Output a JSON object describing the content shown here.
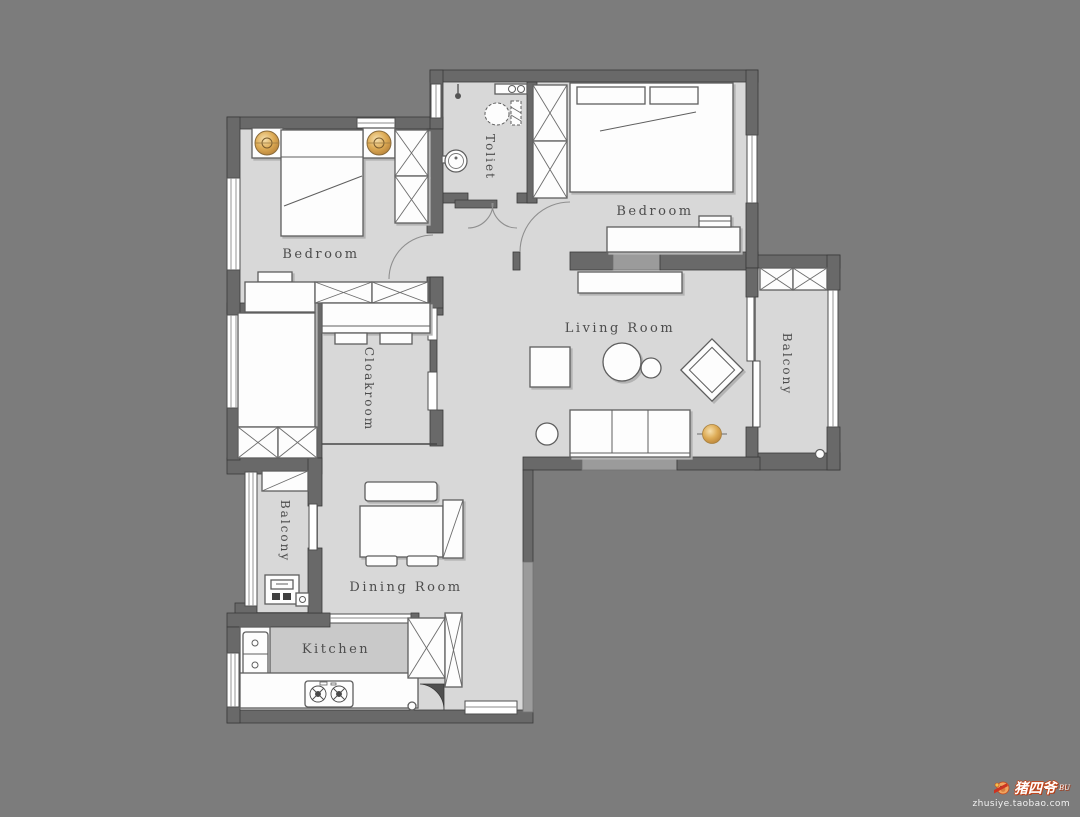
{
  "palette": {
    "background": "#7c7c7c",
    "wall": "#696969",
    "wall_light": "#9b9b9b",
    "floor": "#d8d8d8",
    "furniture": "#fdfdfd",
    "accent_gold": "#d9a84e",
    "label_text": "#4c4c4c"
  },
  "rooms": [
    {
      "id": "bedroom-1",
      "label": "Bedroom",
      "orientation": "horizontal"
    },
    {
      "id": "toilet",
      "label": "Toliet",
      "orientation": "vertical"
    },
    {
      "id": "bedroom-2",
      "label": "Bedroom",
      "orientation": "horizontal"
    },
    {
      "id": "living-room",
      "label": "Living Room",
      "orientation": "horizontal"
    },
    {
      "id": "balcony-right",
      "label": "Balcony",
      "orientation": "vertical"
    },
    {
      "id": "cloakroom",
      "label": "Cloakroom",
      "orientation": "vertical"
    },
    {
      "id": "balcony-left",
      "label": "Balcony",
      "orientation": "vertical"
    },
    {
      "id": "dining-room",
      "label": "Dining Room",
      "orientation": "horizontal"
    },
    {
      "id": "kitchen",
      "label": "Kitchen",
      "orientation": "horizontal"
    }
  ],
  "watermark": {
    "brand": "猪四爷",
    "brand_suffix": "BU",
    "url": "zhusiye.taobao.com"
  }
}
